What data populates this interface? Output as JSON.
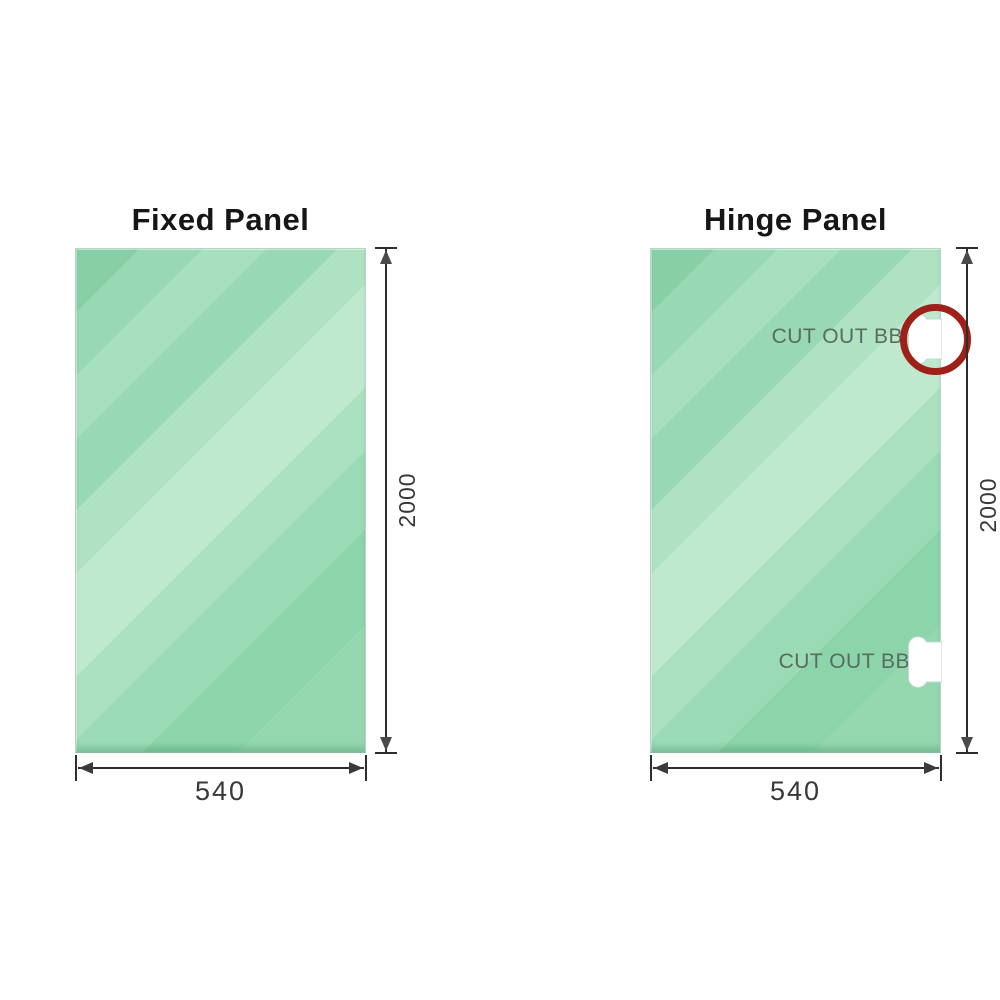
{
  "diagram": {
    "panels": [
      {
        "title": "Fixed Panel",
        "height_label": "2000",
        "width_label": "540",
        "cutouts": []
      },
      {
        "title": "Hinge Panel",
        "height_label": "2000",
        "width_label": "540",
        "cutouts": [
          {
            "label": "CUT OUT BB",
            "highlighted": true
          },
          {
            "label": "CUT OUT BB",
            "highlighted": false
          }
        ]
      }
    ],
    "colors": {
      "glass_green_dark": "#87cfa4",
      "glass_green_light": "#bfe9cf",
      "highlight_circle_red": "#9e2019",
      "dimension_line": "#2d2d2d",
      "cutout_label_text": "#5a6b60",
      "title_text": "#161616"
    }
  }
}
